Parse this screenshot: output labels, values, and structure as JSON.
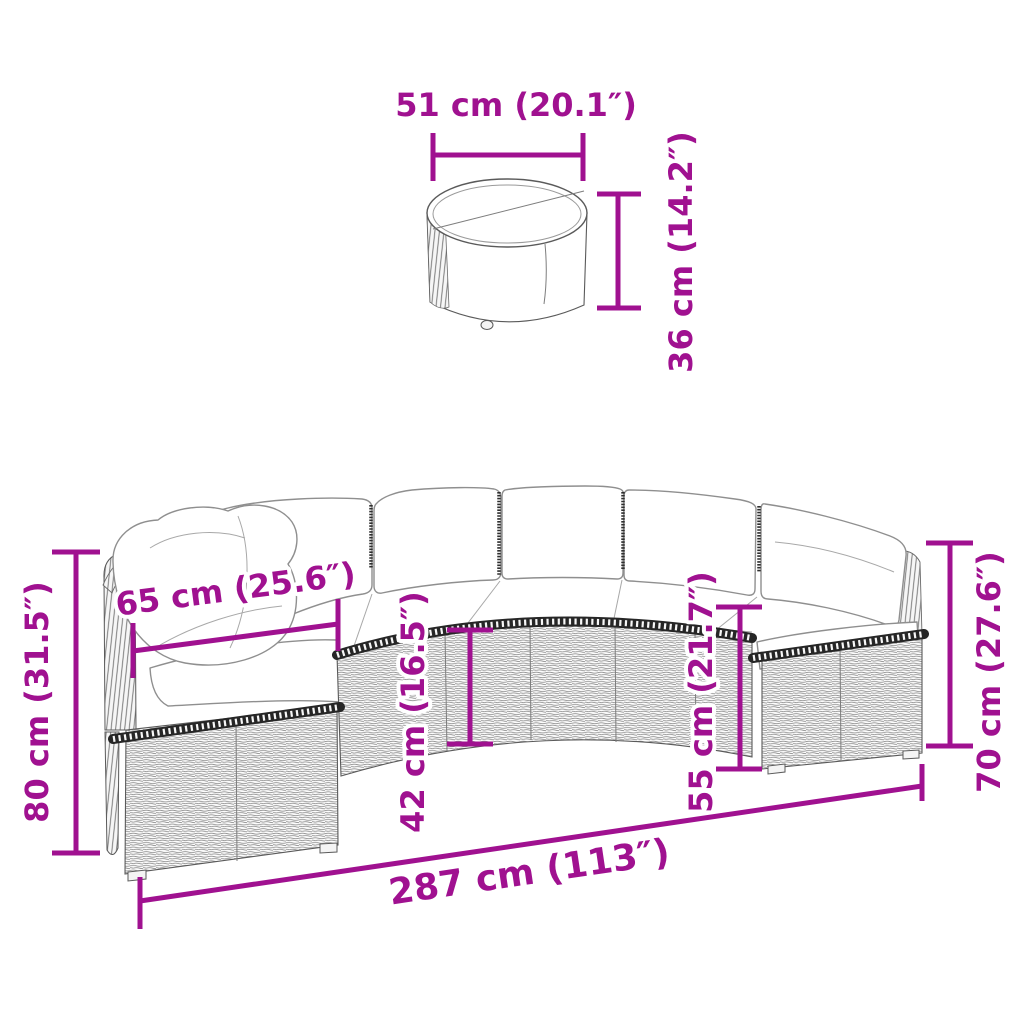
{
  "diagram": {
    "accent_color": "#A01190",
    "line_art_color": "#5a5a5a",
    "background": "#ffffff"
  },
  "table": {
    "width": {
      "cm": "51",
      "inches": "20.1",
      "label": "51 cm (20.1″)"
    },
    "height": {
      "cm": "36",
      "inches": "14.2",
      "label": "36 cm (14.2″)"
    }
  },
  "sofa": {
    "back_height_left": {
      "cm": "80",
      "inches": "31.5",
      "label": "80 cm (31.5″)"
    },
    "seat_depth": {
      "cm": "65",
      "inches": "25.6",
      "label": "65 cm (25.6″)"
    },
    "seat_front_height": {
      "cm": "42",
      "inches": "16.5",
      "label": "42 cm (16.5″)"
    },
    "seat_height": {
      "cm": "55",
      "inches": "21.7",
      "label": "55 cm (21.7″)"
    },
    "back_height_right": {
      "cm": "70",
      "inches": "27.6",
      "label": "70 cm (27.6″)"
    },
    "total_width": {
      "cm": "287",
      "inches": "113",
      "label": "287 cm (113″)"
    }
  }
}
